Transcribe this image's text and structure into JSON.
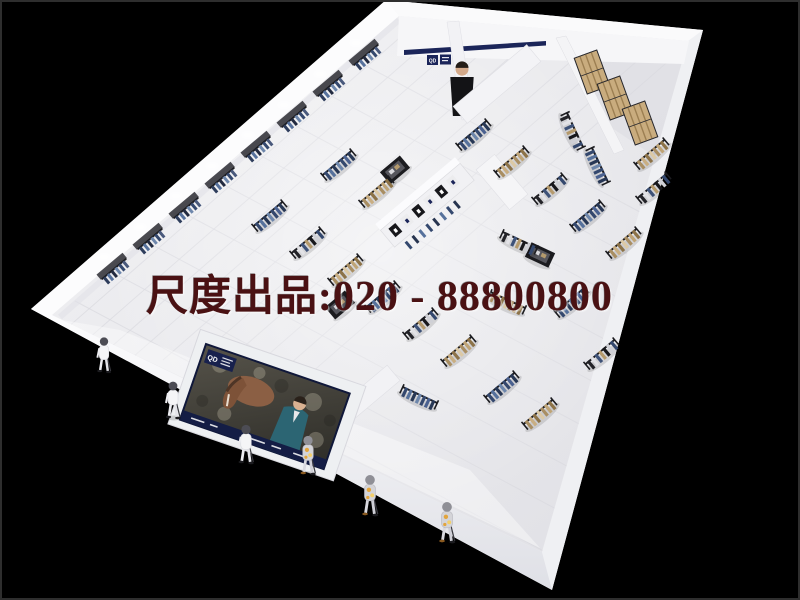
{
  "scene": {
    "description": "3D aerial cutaway render of a long menswear retail store interior on a black background",
    "background_color": "#000000"
  },
  "watermark": {
    "text": "尺度出品:020 - 88800800",
    "color": "#4a1113"
  },
  "brand": {
    "logo": "QD",
    "sign_navy": "#1b2559"
  },
  "billboard": {
    "logo": "QD",
    "border_color": "#141d45"
  },
  "palette": {
    "wall": "#f7f7f9",
    "floor": "#ececef",
    "facade_shadow": "#e4e4ea",
    "rack_frame": "#1c1c20",
    "denim": "#41557b",
    "khaki": "#b49a6d",
    "shelf_wood": "#c9ac7e"
  }
}
